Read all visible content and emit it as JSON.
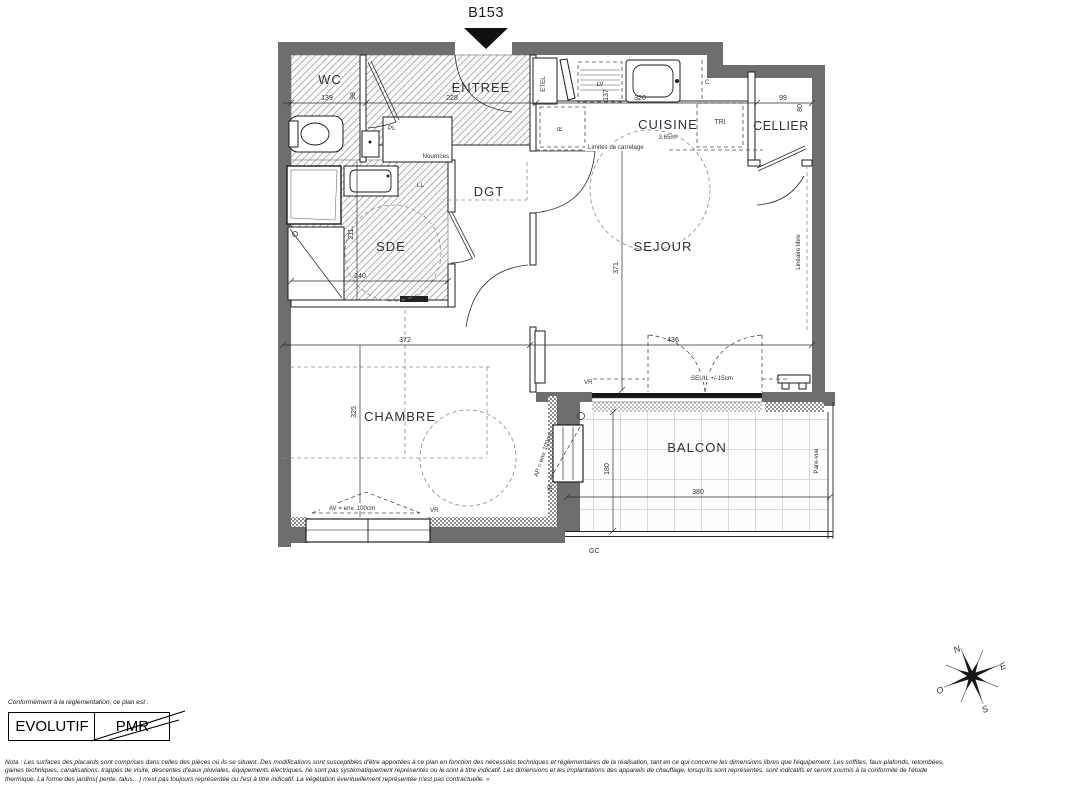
{
  "title": "B153",
  "rooms": {
    "wc": "WC",
    "entree": "ENTREE",
    "dgt": "DGT",
    "sde": "SDE",
    "cuisine": "CUISINE",
    "cuisine_area": "3.65m²",
    "cellier": "CELLIER",
    "sejour": "SEJOUR",
    "chambre": "CHAMBRE",
    "balcon": "BALCON"
  },
  "fixtures": {
    "pl": "PL",
    "nourrices": "Nourrices",
    "ll": "LL",
    "lv": "LV",
    "etel": "ETEL",
    "c": "C",
    "tri": "TRI",
    "r": "R"
  },
  "annotations": {
    "limites": "Limites de carrelage",
    "lineaire": "Linéaire libre",
    "pare_vue": "Pare-vue",
    "gc": "GC",
    "vr": "VR",
    "seuil": "SEUIL +/-15cm",
    "av": "AV = env. 100cm",
    "ap": "AP = env. 100cm"
  },
  "dimensions": {
    "wc_w": "139",
    "wc_h": "98",
    "entree_w": "228",
    "cuisine_w": "320",
    "cuisine_h": "137",
    "cellier_w": "99",
    "cellier_h": "80",
    "sde_h": "211",
    "sde_w": "240",
    "left_w": "372",
    "sejour_w": "436",
    "sejour_h": "371",
    "chambre_h": "325",
    "balcon_h": "180",
    "balcon_w": "380"
  },
  "compass": {
    "n": "N",
    "e": "E",
    "s": "S",
    "o": "O"
  },
  "legend": {
    "intro": "Conformément à la réglementation, ce plan est :",
    "evolutif": "EVOLUTIF",
    "pmr": "PMR"
  },
  "nota": {
    "line1": "Nota : Les surfaces des placards sont comprises dans celles des pièces où ils se situent. Des modifications sont susceptibles d'être apportées à ce plan en fonction des nécessités techniques et réglementaires de la réalisation, tant en ce qui concerne les dimensions libres que l'équipement.  Les soffites, faux-plafonds, retombées,",
    "line2": "gaines techniques, canalisations, trappes de visite, descentes d'eaux pluviales, équipements électriques, ne sont pas systématiquement représentés ou le sont à titre indicatif. Les dimensions et les implantations des appareils de chauffage, lorsqu'ils sont représentés, sont indicatifs et seront soumis à la conformité de l'étude",
    "line3": "thermique. La forme des jardins( pente, talus…) n'est pas toujours représentée ou l'est à titre indicatif. La végétation éventuellement représentée n'est pas contractuelle. »"
  },
  "colors": {
    "wall": "#6e6e6e",
    "line": "#232323",
    "text": "#2e3237"
  }
}
